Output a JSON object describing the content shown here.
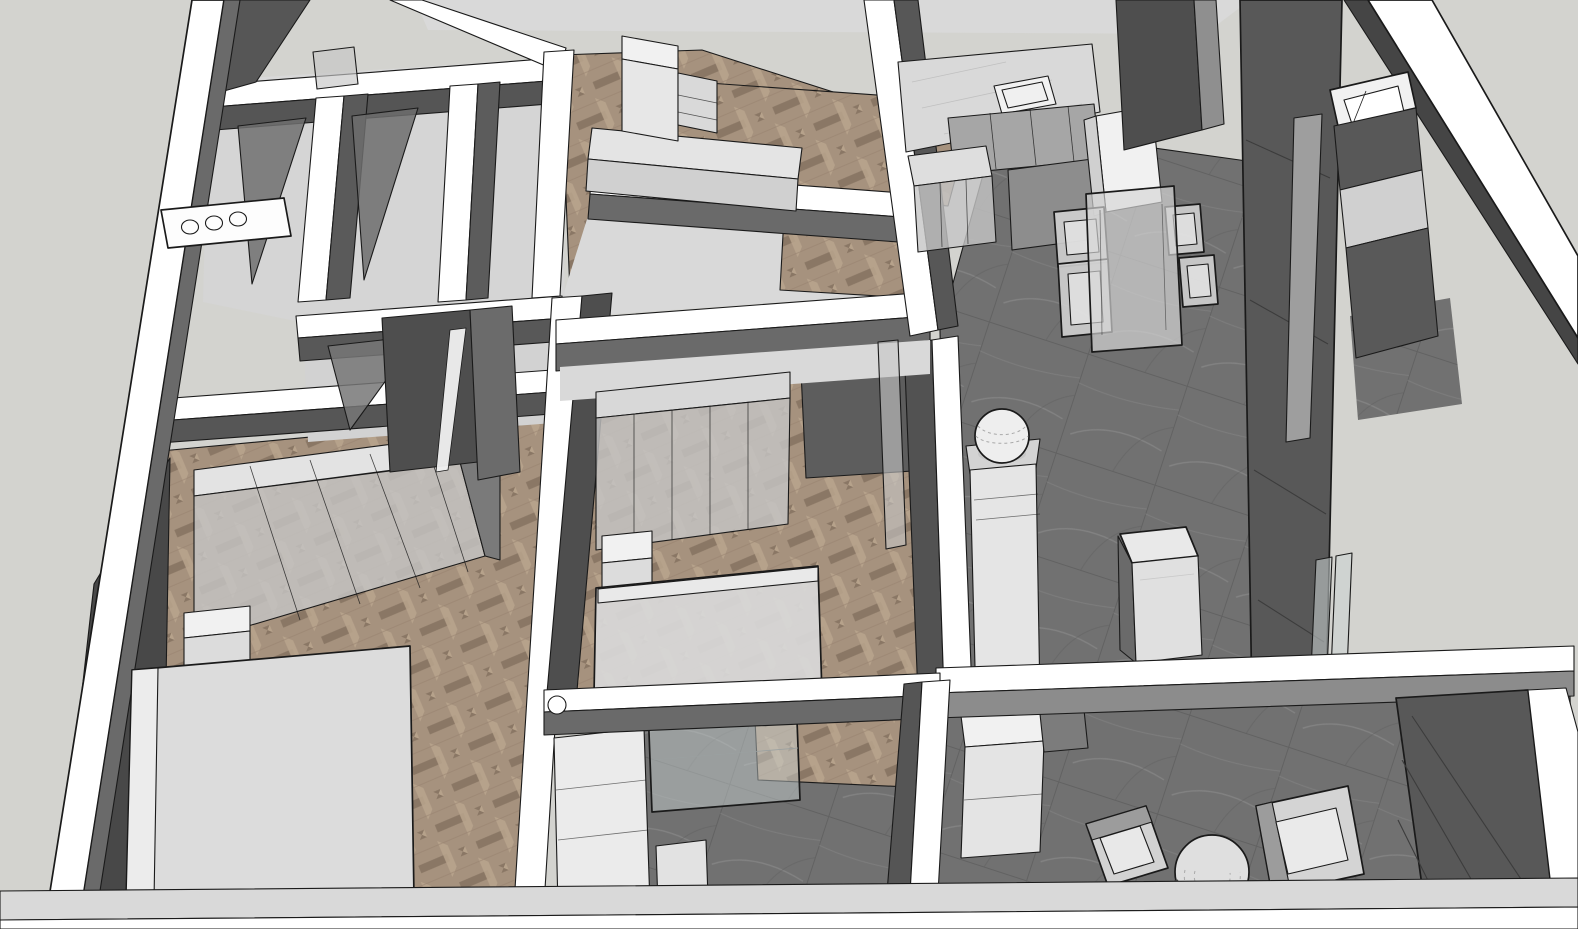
{
  "scene": {
    "kind": "3d-interior-floorplan-render",
    "style": "monochrome-sketch-model-with-wood-floors",
    "view": "aerial-cutaway-perspective",
    "visible_text": "",
    "counts": {
      "dining_stools": 4,
      "cooktop_burners": 3,
      "wardrobe_door_panels": 5,
      "balcony_lounge_chairs": 2,
      "balcony_poufs": 1,
      "glass_swing_doors": 3,
      "beds": 3
    },
    "rooms": [
      {
        "id": "bedroom-1",
        "floor": "herringbone-wood",
        "furniture": [
          "sliding-wardrobe",
          "bed",
          "nightstand",
          "tall-closet"
        ]
      },
      {
        "id": "bedroom-2",
        "floor": "herringbone-wood",
        "furniture": [
          "panel-wardrobe",
          "bed",
          "nightstand",
          "glass-door"
        ]
      },
      {
        "id": "study-room",
        "floor": "herringbone-wood",
        "furniture": [
          "daybed",
          "cabinet",
          "open-shelf"
        ]
      },
      {
        "id": "bathroom-cluster",
        "floor": "light-screed",
        "furniture": [
          "cooktop-counter",
          "glass-doors"
        ]
      },
      {
        "id": "hallway",
        "floor": "herringbone-wood",
        "furniture": []
      },
      {
        "id": "kitchen",
        "floor": "dark-stone-tile",
        "furniture": [
          "counter-with-sink",
          "worktop",
          "glass-front-counter",
          "tall-cabinet"
        ]
      },
      {
        "id": "dining",
        "floor": "dark-stone-tile",
        "furniture": [
          "glass-dining-table",
          "stools",
          "pedestal-with-sphere",
          "island-cabinet"
        ]
      },
      {
        "id": "living-entry",
        "floor": "dark-stone-tile",
        "furniture": [
          "media-panel-wall",
          "entry-cabinets",
          "open-window-pane",
          "balcony-glass-doors"
        ]
      },
      {
        "id": "bathroom-2",
        "floor": "dark-stone-tile",
        "furniture": [
          "vanity",
          "shower-glass-screen",
          "storage-box"
        ]
      },
      {
        "id": "balcony",
        "floor": "dark-stone-tile",
        "furniture": [
          "cabinet",
          "lounge-chairs",
          "woven-pouf"
        ]
      }
    ]
  },
  "palette": {
    "bg": "#d3d3cf",
    "band": "#ffffff",
    "edge": "#1a1a1a",
    "seam": "#3c3c3c",
    "wallDeep": "#484848",
    "wallDark": "#4e4e4e",
    "wallMid": "#6a6a6a",
    "wallSoft": "#8c8c8c",
    "faceLight": "#d9d9d9",
    "floorLight": "#d5d5d5",
    "furnWhite": "#f1f1f1",
    "furnSoft": "#e5e5e5",
    "furnMid": "#d0d0d0",
    "glassTint": "#c6c6c6",
    "glassCool": "#ccd4d4",
    "panelDark": "#585858",
    "panelLight": "#9e9e9e",
    "woodBase": "#a6927e",
    "woodDark": "#8a7765",
    "woodLight": "#b9a48d",
    "tileBase": "#717171",
    "tileLine": "#626262",
    "tileVein": "#989898"
  }
}
